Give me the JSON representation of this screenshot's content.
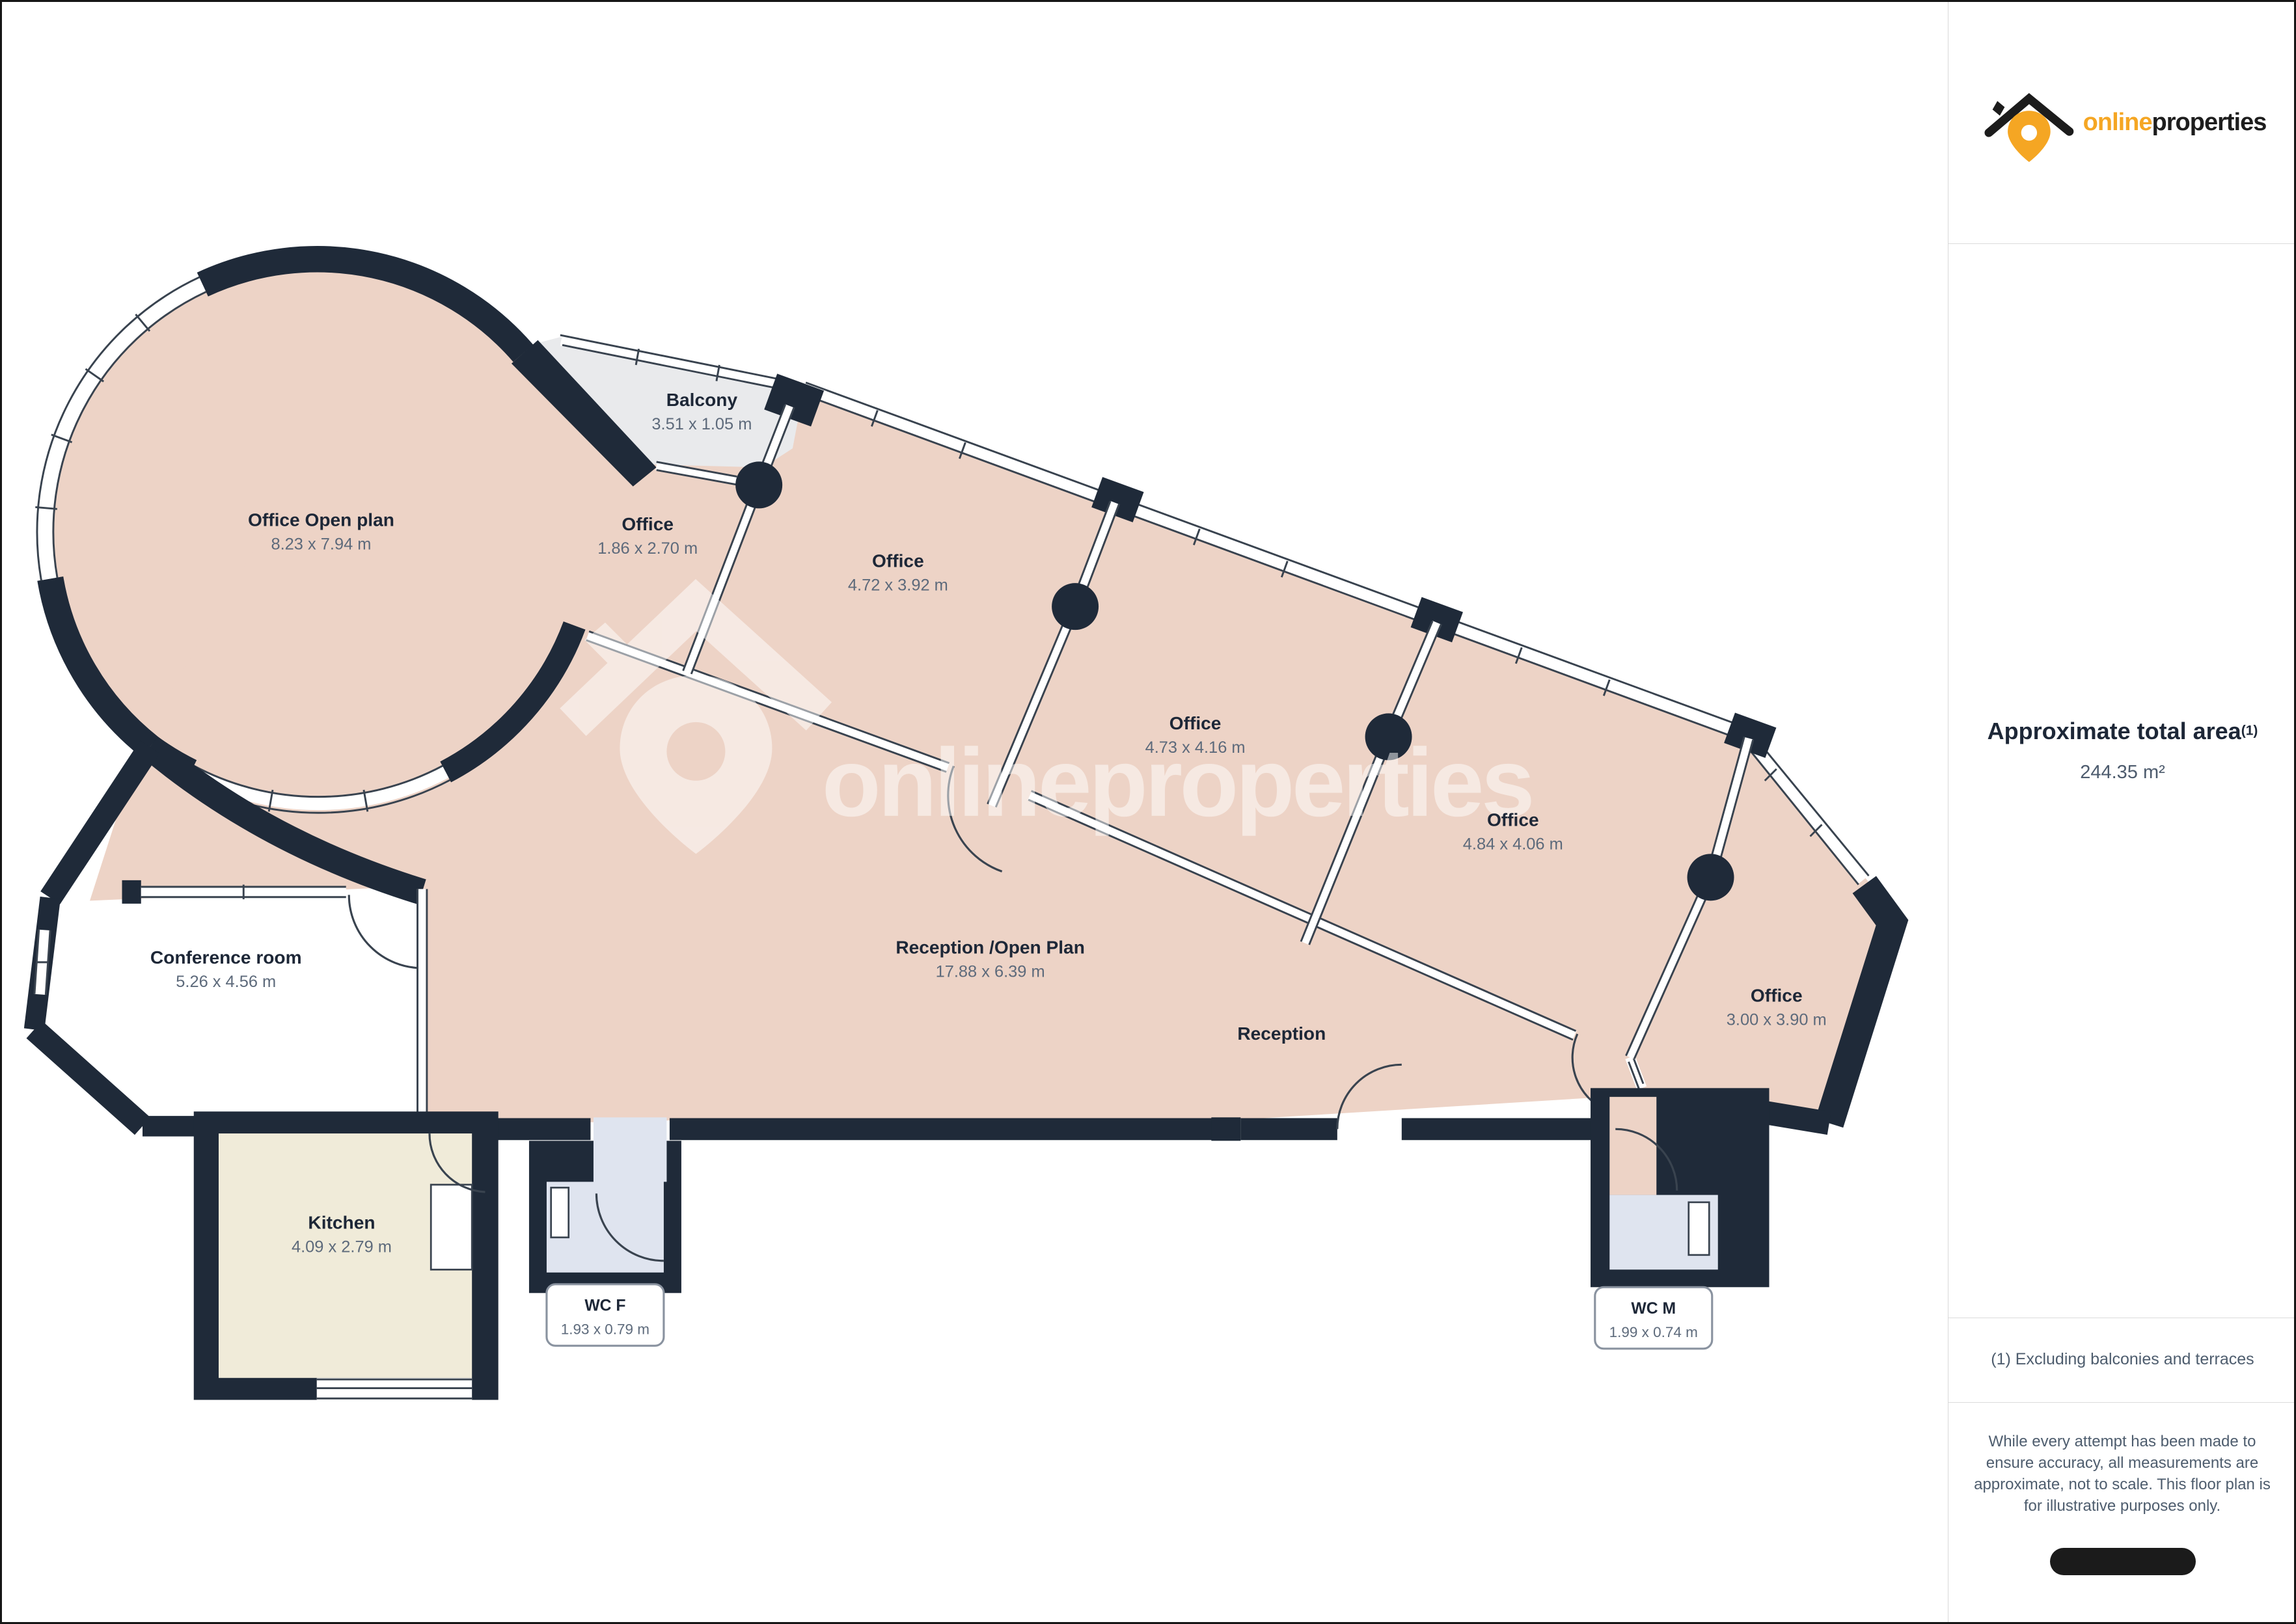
{
  "branding": {
    "logo_online": "online",
    "logo_properties": "properties",
    "watermark": "onlineproperties"
  },
  "sidebar": {
    "area_title": "Approximate total area",
    "area_superscript": "(1)",
    "area_value": "244.35 m²",
    "footnote": "(1) Excluding balconies and terraces",
    "disclaimer": "While every attempt has been made to ensure accuracy, all measurements are approximate, not to scale. This floor plan is for illustrative purposes only."
  },
  "rooms": [
    {
      "name": "Office Open plan",
      "dims": "8.23 x 7.94 m"
    },
    {
      "name": "Balcony",
      "dims": "3.51 x 1.05 m"
    },
    {
      "name": "Office",
      "dims": "1.86 x 2.70 m"
    },
    {
      "name": "Office",
      "dims": "4.72 x 3.92 m"
    },
    {
      "name": "Office",
      "dims": "4.73 x 4.16 m"
    },
    {
      "name": "Office",
      "dims": "4.84 x 4.06 m"
    },
    {
      "name": "Office",
      "dims": "3.00 x 3.90 m"
    },
    {
      "name": "Conference room",
      "dims": "5.26 x 4.56 m"
    },
    {
      "name": "Reception /Open Plan",
      "dims": "17.88 x 6.39 m"
    },
    {
      "name": "Reception",
      "dims": ""
    },
    {
      "name": "Kitchen",
      "dims": "4.09 x 2.79 m"
    },
    {
      "name": "WC F",
      "dims": "1.93 x 0.79 m"
    },
    {
      "name": "WC M",
      "dims": "1.99 x 0.74 m"
    }
  ],
  "colors": {
    "accent_orange": "#f5a623",
    "wall": "#1f2a39",
    "floor": "#edd3c6",
    "kitchen_floor": "#f0ebd9",
    "wc_floor": "#dfe4ef",
    "balcony_floor": "#e9eaec",
    "text_dark": "#1d2737",
    "text_dim": "#5d6a7b"
  }
}
